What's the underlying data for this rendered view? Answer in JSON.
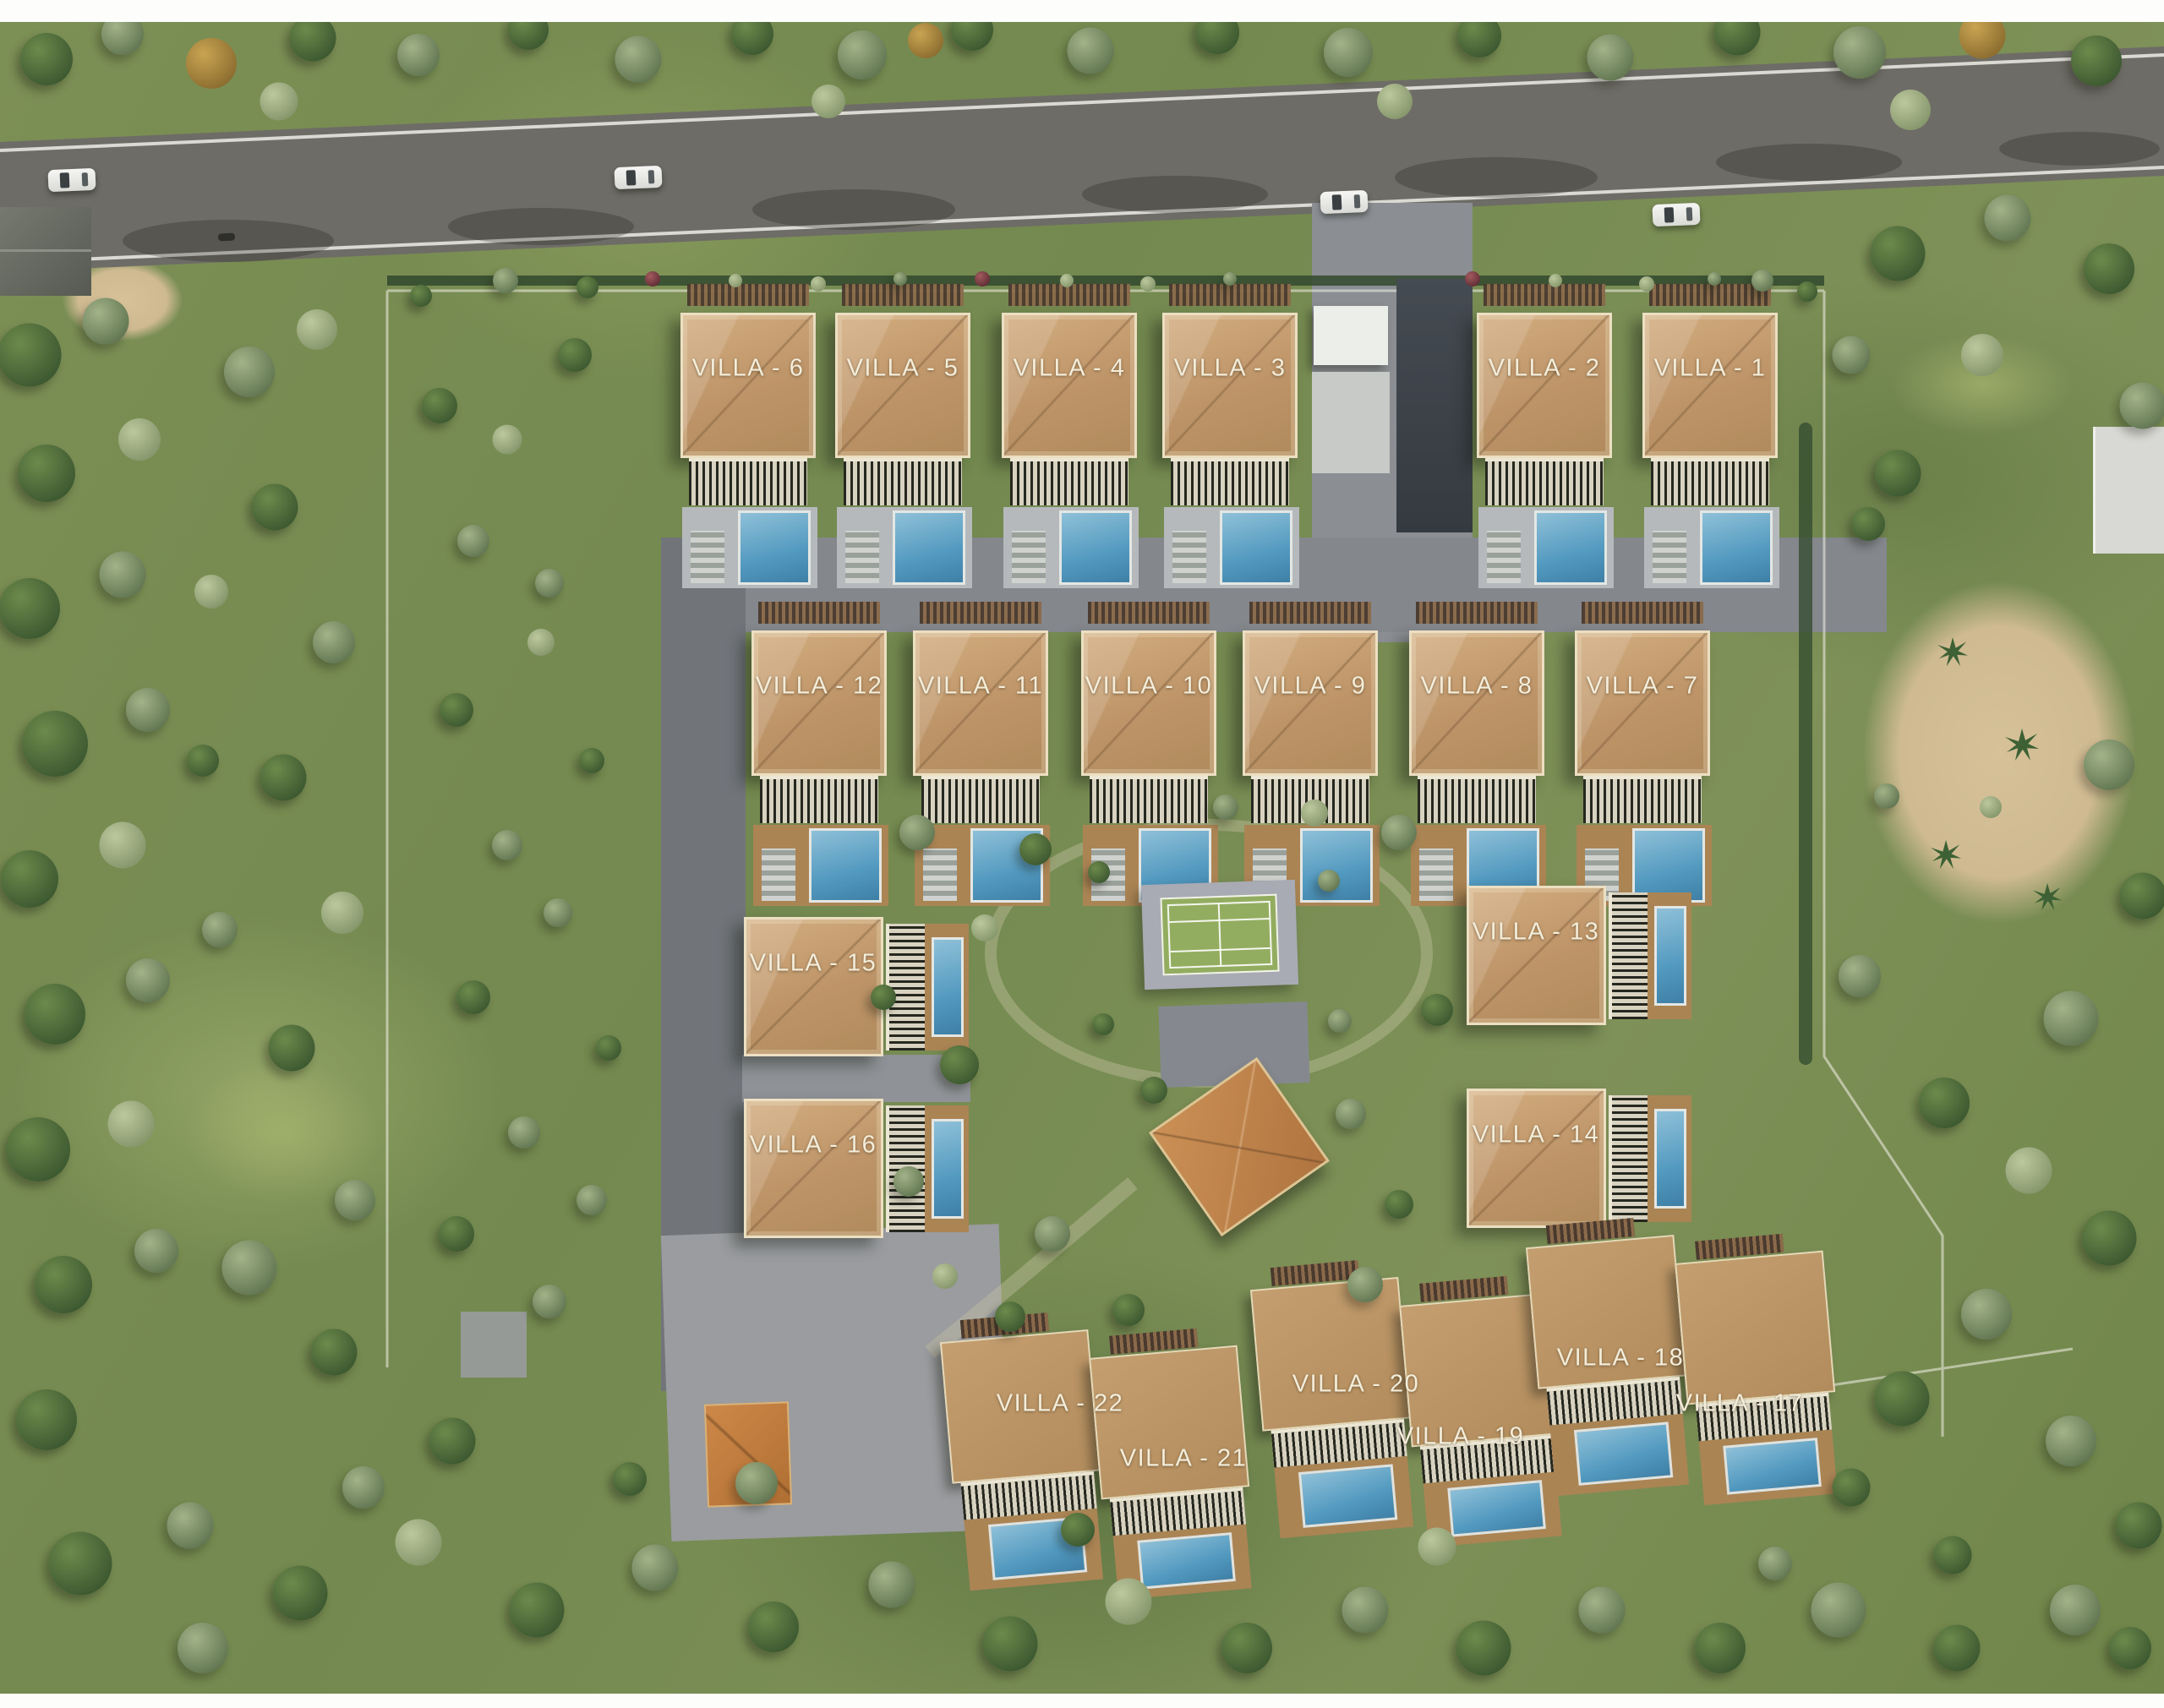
{
  "scene": {
    "description": "Aerial 3D master plan of a gated villa community beside a road, with pools, tennis court and clubhouse",
    "villa_count": 22
  },
  "villas": {
    "v1": "VILLA - 1",
    "v2": "VILLA - 2",
    "v3": "VILLA - 3",
    "v4": "VILLA - 4",
    "v5": "VILLA - 5",
    "v6": "VILLA - 6",
    "v7": "VILLA - 7",
    "v8": "VILLA - 8",
    "v9": "VILLA - 9",
    "v10": "VILLA - 10",
    "v11": "VILLA - 11",
    "v12": "VILLA - 12",
    "v13": "VILLA - 13",
    "v14": "VILLA - 14",
    "v15": "VILLA - 15",
    "v16": "VILLA - 16",
    "v17": "VILLA - 17",
    "v18": "VILLA - 18",
    "v19": "VILLA - 19",
    "v20": "VILLA - 20",
    "v21": "VILLA - 21",
    "v22": "VILLA - 22"
  },
  "features": {
    "tennis_court": "tennis-court",
    "clubhouse": "clubhouse",
    "pool_kiosk": "pool-kiosk",
    "entrance_gate": "entrance-gate",
    "main_road": "main-road",
    "internal_road": "internal-road"
  },
  "colors": {
    "roof_tan": "#bf9a6a",
    "label_text": "#f3edda",
    "pool_blue": "#539ac0",
    "grass": "#76894f",
    "road_asphalt": "#6e6c66",
    "paving_gray": "#8b8e92",
    "court_green": "#93ad60",
    "clubhouse_roof": "#b07440",
    "sand": "#d4bf98",
    "white_frame": "#ecdfc2"
  }
}
